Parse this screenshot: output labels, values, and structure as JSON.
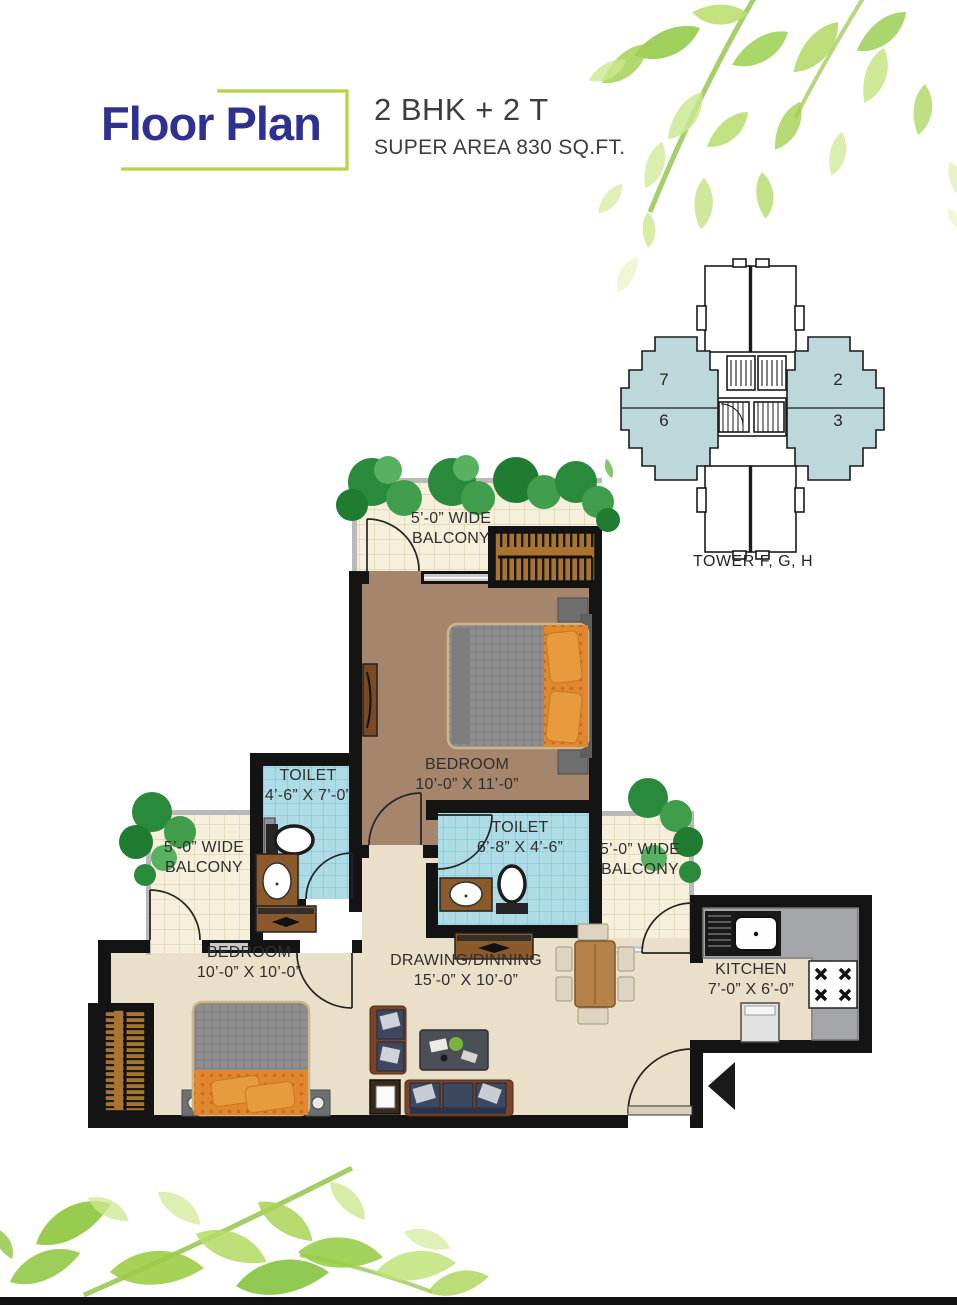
{
  "header": {
    "title": "Floor Plan",
    "unit_type": "2 BHK + 2 T",
    "super_area": "SUPER AREA 830 SQ.FT."
  },
  "key_plan": {
    "tower_label": "TOWER F, G, H",
    "unit_numbers": [
      "7",
      "6",
      "2",
      "3"
    ]
  },
  "rooms": {
    "balcony_top": {
      "line1": "5’-0” WIDE",
      "line2": "BALCONY"
    },
    "bedroom_top": {
      "name": "BEDROOM",
      "dims": "10’-0” X 11’-0”"
    },
    "toilet_1": {
      "name": "TOILET",
      "dims": "4’-6” X 7’-0”"
    },
    "toilet_2": {
      "name": "TOILET",
      "dims": "6’-8” X 4’-6”"
    },
    "balcony_left": {
      "line1": "5’-0” WIDE",
      "line2": "BALCONY"
    },
    "balcony_right": {
      "line1": "5’-0” WIDE",
      "line2": "BALCONY"
    },
    "bedroom_bottom": {
      "name": "BEDROOM",
      "dims": "10’-0” X 10’-0”"
    },
    "drawing_dining": {
      "name": "DRAWING/DINNING",
      "dims": "15’-0” X 10’-0”"
    },
    "kitchen": {
      "name": "KITCHEN",
      "dims": "7’-0” X 6’-0”"
    }
  },
  "colors": {
    "title_navy": "#2e3192",
    "frame_green": "#b5d347",
    "wing_blue": "#bcd8db",
    "wall_black": "#141414",
    "tile_cream": "#f6efdb",
    "tile_blue": "#aedce6",
    "floor_brown": "#a5856b",
    "floor_cream": "#eadfc8",
    "accent_orange": "#e0872f",
    "leaf_green": "#9ccd45"
  }
}
